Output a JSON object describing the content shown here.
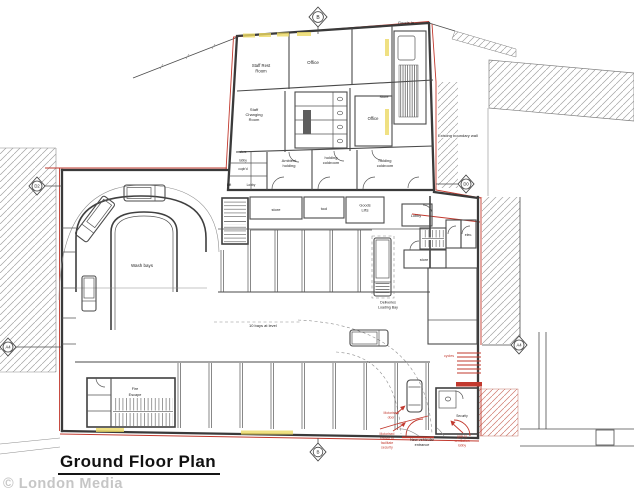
{
  "doc": {
    "title": "Ground Floor Plan",
    "watermark": "© London Media"
  },
  "grid_markers": {
    "top": "B",
    "bottom": "B",
    "left": "D2",
    "right": "D0",
    "bottom_left": "A4",
    "bottom_right": "A4"
  },
  "rooms": {
    "staff_rest_l1": "Staff Rest",
    "staff_rest_l2": "Room",
    "office_top": "Office",
    "changing_l1": "Staff",
    "changing_l2": "Changing",
    "changing_l3": "Room",
    "office_mid": "Office",
    "store_top": "Store",
    "ambient_l1": "Ambient",
    "ambient_l2": "holding",
    "cold1_l1": "holding",
    "cold1_l2": "coldroom",
    "cold2_l1": "holding",
    "cold2_l2": "coldroom",
    "store_left": "store",
    "lobby_left": "lobby",
    "cupbd": "cupb'd",
    "lift": "Lift",
    "lobby_mid": "Lobby",
    "store_row": "store",
    "tool": "tool",
    "goods_l1": "Goods",
    "goods_l2": "Lifts",
    "lobby_right": "Lobby",
    "store_right": "store",
    "elec": "elec.",
    "wash_bays": "Wash bays",
    "fire_l1": "Fire",
    "fire_l2": "Escape",
    "security": "Security"
  },
  "site": {
    "goods_in": "Goods In",
    "boundary": "Existing boundary wall",
    "deliv_l1": "Deliveries",
    "deliv_l2": "Loading Bay",
    "aisle": "10 bays at level",
    "cycles": "cycles"
  },
  "annotations": {
    "scr1": "Motorised",
    "scr2": "screen to",
    "scr3": "facilitate",
    "scr4": "security",
    "ent1": "New vehicular",
    "ent2": "entrance",
    "gate1": "gate to",
    "gate2": "ventilation",
    "gate3": "lobby",
    "door1": "Motorised",
    "door2": "door"
  },
  "colors": {
    "red": "#c2392e",
    "wall": "#3a3a3a",
    "hatch": "#a3a3a3",
    "highlight": "#ecd964",
    "watermark": "#c6c6c6"
  }
}
